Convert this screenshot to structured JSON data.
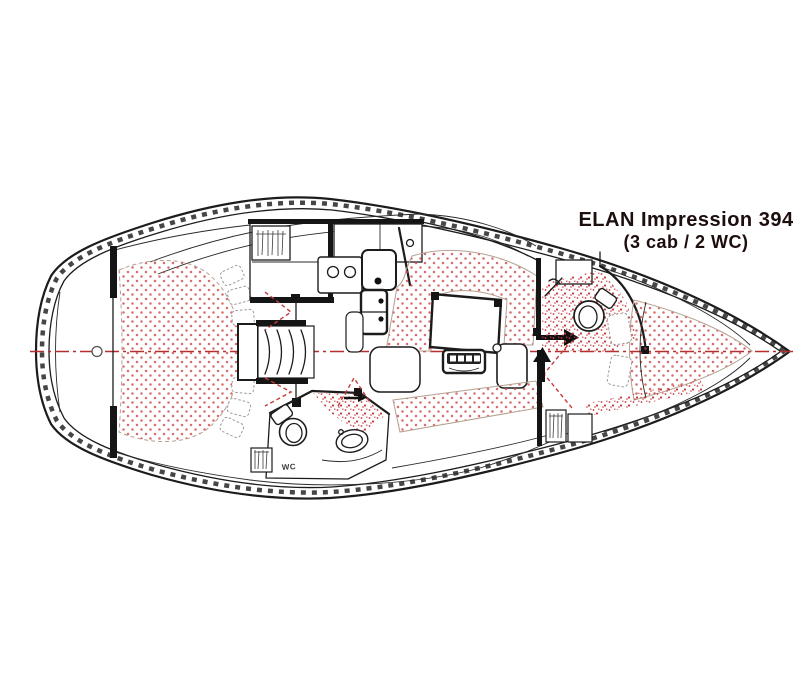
{
  "diagram": {
    "title": {
      "line1": "ELAN Impression 394",
      "line2": "(3 cab / 2 WC)"
    },
    "labels": {
      "wc": "WC"
    },
    "colors": {
      "ink": "#1c1c1c",
      "title": "#1d0d0d",
      "centerline": "#b52f2f",
      "upholstery_dot": "#cc4848",
      "shower_speckle": "#c43b3b",
      "background": "#ffffff"
    }
  }
}
